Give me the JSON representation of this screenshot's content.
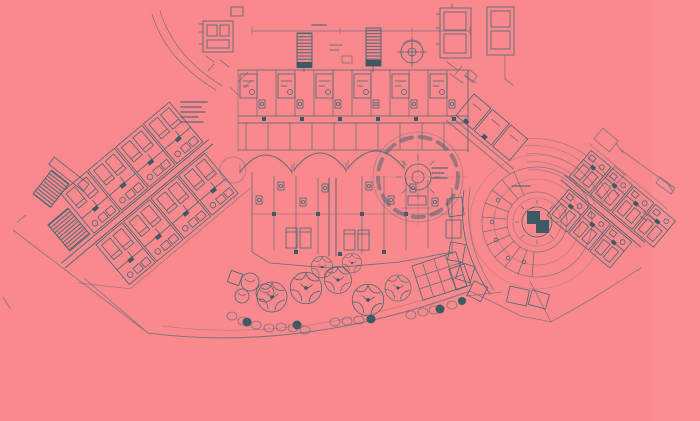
{
  "canvas": {
    "width": 700,
    "height": 421
  },
  "palette": {
    "paper_pink": "#f9898d",
    "paper_pink_light": "#fa9599",
    "ink_teal": "#3a6470",
    "ink_dark": "#2e5660"
  },
  "drawing": {
    "kind": "architectural floor plan (blueprint scan on pink paper)",
    "legible_text": [],
    "features": [
      "top guest-room block with corridor",
      "hatched elevator shafts",
      "circular stair with crosshair",
      "round hall with panel ring",
      "central suite cluster with scalloped arches",
      "left diagonal guest wing",
      "right spiral wing with pinwheel core and radiating rooms",
      "right diagonal guest wing",
      "stair towers",
      "terrace promenade with trees and shrubs",
      "pergola grid",
      "site boundary and dimension lines",
      "illegible micro-annotations"
    ]
  }
}
